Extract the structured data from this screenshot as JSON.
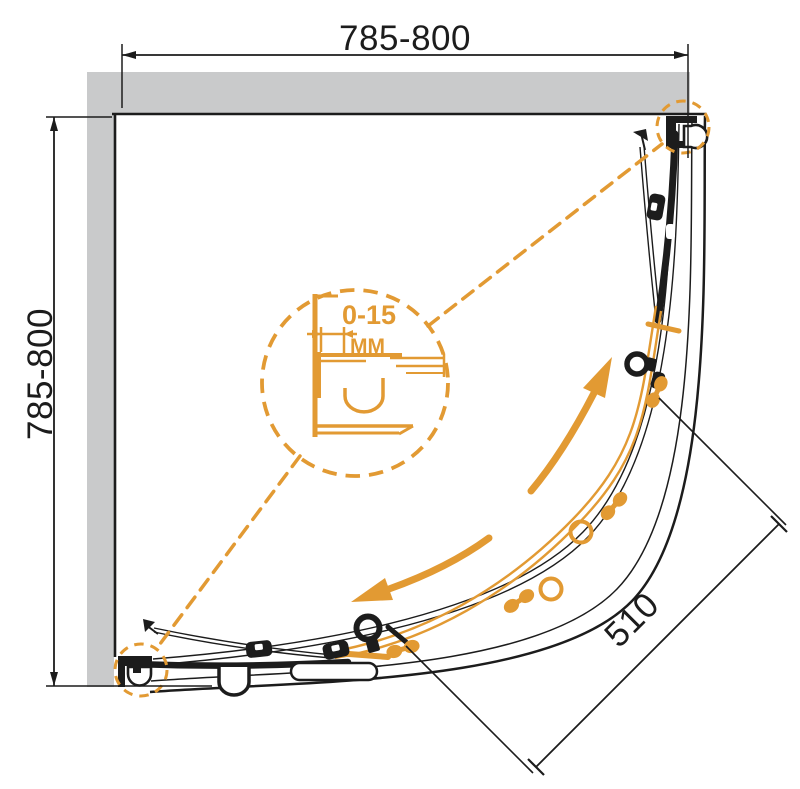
{
  "diagram": {
    "title": "quadrant-shower-enclosure-plan",
    "dimensions": {
      "width_top": "785-800",
      "height_left": "785-800",
      "entry_diagonal": "510",
      "adjustment_range": "0-15",
      "adjustment_unit": "MM"
    },
    "colors": {
      "accent_orange": "#E29A33",
      "line_black": "#1C1C1C",
      "wall_gray": "#C9CACB"
    }
  }
}
